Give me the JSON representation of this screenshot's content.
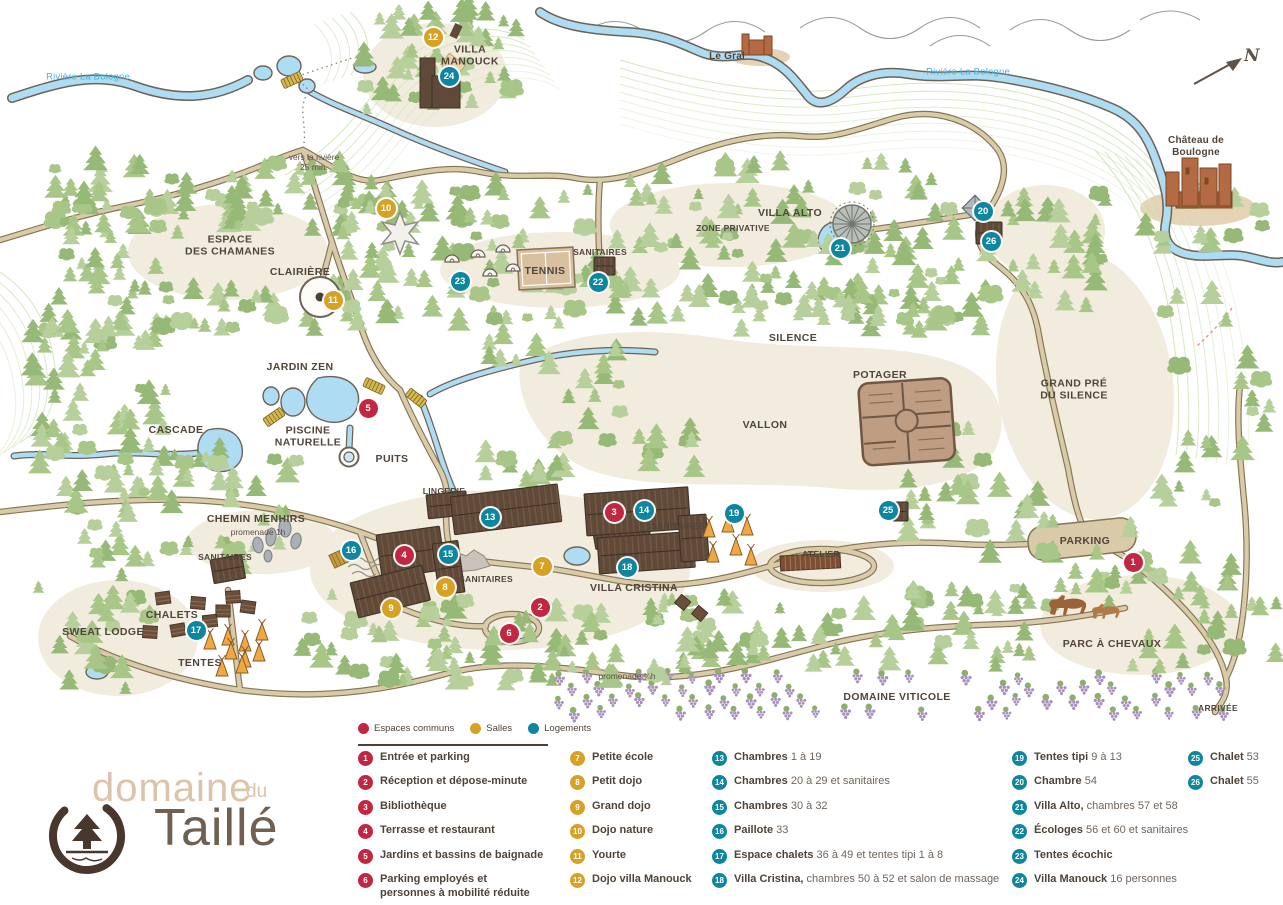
{
  "logo": {
    "word1": "domaine",
    "word2": "du",
    "word3": "Taillé"
  },
  "compass": {
    "label": "N"
  },
  "colors": {
    "red": "#c22742",
    "gold": "#d7a124",
    "teal": "#0e86a0",
    "river": "#aedcf2",
    "river_label": "#49b4d9",
    "path": "#d9cba8",
    "path_edge": "#857456",
    "tree": "#a7c687",
    "beige": "#f1ecdd",
    "building": "#5f4938",
    "text": "#51453a"
  },
  "legend": {
    "key": [
      {
        "label": "Espaces communs",
        "color": "red"
      },
      {
        "label": "Salles",
        "color": "gold"
      },
      {
        "label": "Logements",
        "color": "teal"
      }
    ],
    "columns": [
      {
        "items": [
          {
            "number": "1",
            "color": "red",
            "bold": "Entrée et parking",
            "rest": ""
          },
          {
            "number": "2",
            "color": "red",
            "bold": "Réception et dépose-minute",
            "rest": ""
          },
          {
            "number": "3",
            "color": "red",
            "bold": "Bibliothèque",
            "rest": ""
          },
          {
            "number": "4",
            "color": "red",
            "bold": "Terrasse et restaurant",
            "rest": ""
          },
          {
            "number": "5",
            "color": "red",
            "bold": "Jardins et bassins de baignade",
            "rest": ""
          },
          {
            "number": "6",
            "color": "red",
            "bold": "Parking employés et\npersonnes à mobilité réduite",
            "rest": ""
          }
        ]
      },
      {
        "items": [
          {
            "number": "7",
            "color": "gold",
            "bold": "Petite école",
            "rest": ""
          },
          {
            "number": "8",
            "color": "gold",
            "bold": "Petit dojo",
            "rest": ""
          },
          {
            "number": "9",
            "color": "gold",
            "bold": "Grand dojo",
            "rest": ""
          },
          {
            "number": "10",
            "color": "gold",
            "bold": "Dojo nature",
            "rest": ""
          },
          {
            "number": "11",
            "color": "gold",
            "bold": "Yourte",
            "rest": ""
          },
          {
            "number": "12",
            "color": "gold",
            "bold": "Dojo villa Manouck",
            "rest": ""
          }
        ]
      },
      {
        "items": [
          {
            "number": "13",
            "color": "teal",
            "bold": "Chambres",
            "rest": "1 à 19"
          },
          {
            "number": "14",
            "color": "teal",
            "bold": "Chambres",
            "rest": "20 à 29 et sanitaires"
          },
          {
            "number": "15",
            "color": "teal",
            "bold": "Chambres",
            "rest": "30 à 32"
          },
          {
            "number": "16",
            "color": "teal",
            "bold": "Paillote",
            "rest": "33"
          },
          {
            "number": "17",
            "color": "teal",
            "bold": "Espace chalets",
            "rest": "36 à 49 et tentes tipi 1 à 8"
          },
          {
            "number": "18",
            "color": "teal",
            "bold": "Villa Cristina,",
            "rest": "chambres 50 à 52 et salon de massage"
          }
        ]
      },
      {
        "items": [
          {
            "number": "19",
            "color": "teal",
            "bold": "Tentes tipi",
            "rest": "9 à 13"
          },
          {
            "number": "20",
            "color": "teal",
            "bold": "Chambre",
            "rest": "54"
          },
          {
            "number": "21",
            "color": "teal",
            "bold": "Villa Alto,",
            "rest": "chambres 57 et 58"
          },
          {
            "number": "22",
            "color": "teal",
            "bold": "Écologes",
            "rest": "56 et 60 et sanitaires"
          },
          {
            "number": "23",
            "color": "teal",
            "bold": "Tentes écochic",
            "rest": ""
          },
          {
            "number": "24",
            "color": "teal",
            "bold": "Villa Manouck",
            "rest": "16 personnes"
          }
        ]
      },
      {
        "items": [
          {
            "number": "25",
            "color": "teal",
            "bold": "Chalet",
            "rest": "53"
          },
          {
            "number": "26",
            "color": "teal",
            "bold": "Chalet",
            "rest": "55"
          }
        ]
      }
    ]
  },
  "map": {
    "labels": [
      {
        "text": "Rivière La Bologne",
        "x": 88,
        "y": 77,
        "type": "river"
      },
      {
        "text": "Rivière La Bologne",
        "x": 968,
        "y": 72,
        "type": "river"
      },
      {
        "text": "VILLA\nMANOUCK",
        "x": 470,
        "y": 56,
        "type": "area"
      },
      {
        "text": "vers la rivière\n25 min.",
        "x": 314,
        "y": 162,
        "type": "small"
      },
      {
        "text": "Le Gral",
        "x": 727,
        "y": 57,
        "type": "place"
      },
      {
        "text": "Château de Boulogne",
        "x": 1196,
        "y": 147,
        "type": "place"
      },
      {
        "text": "ESPACE\nDES CHAMANES",
        "x": 230,
        "y": 246,
        "type": "area"
      },
      {
        "text": "ZONE PRIVATIVE",
        "x": 733,
        "y": 228,
        "type": "area-sm"
      },
      {
        "text": "VILLA ALTO",
        "x": 790,
        "y": 213,
        "type": "area"
      },
      {
        "text": "CLAIRIÈRE",
        "x": 300,
        "y": 272,
        "type": "area"
      },
      {
        "text": "TENNIS",
        "x": 545,
        "y": 271,
        "type": "area"
      },
      {
        "text": "SANITAIRES",
        "x": 600,
        "y": 252,
        "type": "area-sm"
      },
      {
        "text": "SILENCE",
        "x": 793,
        "y": 338,
        "type": "area"
      },
      {
        "text": "JARDIN ZEN",
        "x": 300,
        "y": 367,
        "type": "area"
      },
      {
        "text": "POTAGER",
        "x": 880,
        "y": 375,
        "type": "area"
      },
      {
        "text": "GRAND PRÉ\nDU SILENCE",
        "x": 1074,
        "y": 390,
        "type": "area"
      },
      {
        "text": "CASCADE",
        "x": 176,
        "y": 430,
        "type": "area"
      },
      {
        "text": "PISCINE\nNATURELLE",
        "x": 308,
        "y": 437,
        "type": "area"
      },
      {
        "text": "VALLON",
        "x": 765,
        "y": 425,
        "type": "area"
      },
      {
        "text": "PUITS",
        "x": 392,
        "y": 459,
        "type": "area"
      },
      {
        "text": "CHEMIN MENHIRS",
        "x": 256,
        "y": 519,
        "type": "area"
      },
      {
        "text": "promenade 1h",
        "x": 258,
        "y": 532,
        "type": "small"
      },
      {
        "text": "SANITAIRES",
        "x": 225,
        "y": 557,
        "type": "area-sm"
      },
      {
        "text": "LINGERIE",
        "x": 444,
        "y": 491,
        "type": "area-sm"
      },
      {
        "text": "SANITAIRES",
        "x": 486,
        "y": 579,
        "type": "area-sm"
      },
      {
        "text": "SANITAIRES",
        "x": 678,
        "y": 526,
        "type": "area-sm"
      },
      {
        "text": "VILLA CRISTINA",
        "x": 634,
        "y": 588,
        "type": "area"
      },
      {
        "text": "SWEAT LODGE",
        "x": 103,
        "y": 632,
        "type": "area"
      },
      {
        "text": "CHALETS",
        "x": 172,
        "y": 615,
        "type": "area"
      },
      {
        "text": "TENTES",
        "x": 200,
        "y": 663,
        "type": "area"
      },
      {
        "text": "ATELIER",
        "x": 821,
        "y": 554,
        "type": "area-sm"
      },
      {
        "text": "PARKING",
        "x": 1085,
        "y": 541,
        "type": "area"
      },
      {
        "text": "PARC À CHEVAUX",
        "x": 1112,
        "y": 644,
        "type": "area"
      },
      {
        "text": "ARRIVÉE",
        "x": 1218,
        "y": 708,
        "type": "area-sm"
      },
      {
        "text": "DOMAINE VITICOLE",
        "x": 897,
        "y": 697,
        "type": "area"
      },
      {
        "text": "promenade ¼h",
        "x": 627,
        "y": 676,
        "type": "small"
      }
    ],
    "markers": [
      {
        "number": "1",
        "color": "red",
        "x": 1133,
        "y": 562
      },
      {
        "number": "2",
        "color": "red",
        "x": 540,
        "y": 607
      },
      {
        "number": "3",
        "color": "red",
        "x": 614,
        "y": 512
      },
      {
        "number": "4",
        "color": "red",
        "x": 404,
        "y": 555
      },
      {
        "number": "5",
        "color": "red",
        "x": 368,
        "y": 408
      },
      {
        "number": "6",
        "color": "red",
        "x": 509,
        "y": 633
      },
      {
        "number": "7",
        "color": "gold",
        "x": 542,
        "y": 566
      },
      {
        "number": "8",
        "color": "gold",
        "x": 445,
        "y": 587
      },
      {
        "number": "9",
        "color": "gold",
        "x": 391,
        "y": 608
      },
      {
        "number": "10",
        "color": "gold",
        "x": 386,
        "y": 208
      },
      {
        "number": "11",
        "color": "gold",
        "x": 333,
        "y": 300
      },
      {
        "number": "12",
        "color": "gold",
        "x": 433,
        "y": 37
      },
      {
        "number": "13",
        "color": "teal",
        "x": 490,
        "y": 517
      },
      {
        "number": "14",
        "color": "teal",
        "x": 644,
        "y": 510
      },
      {
        "number": "15",
        "color": "teal",
        "x": 448,
        "y": 554
      },
      {
        "number": "16",
        "color": "teal",
        "x": 351,
        "y": 550
      },
      {
        "number": "17",
        "color": "teal",
        "x": 196,
        "y": 630
      },
      {
        "number": "18",
        "color": "teal",
        "x": 627,
        "y": 567
      },
      {
        "number": "19",
        "color": "teal",
        "x": 734,
        "y": 513
      },
      {
        "number": "20",
        "color": "teal",
        "x": 983,
        "y": 211
      },
      {
        "number": "21",
        "color": "teal",
        "x": 840,
        "y": 248
      },
      {
        "number": "22",
        "color": "teal",
        "x": 598,
        "y": 282
      },
      {
        "number": "23",
        "color": "teal",
        "x": 460,
        "y": 281
      },
      {
        "number": "24",
        "color": "teal",
        "x": 449,
        "y": 76
      },
      {
        "number": "25",
        "color": "teal",
        "x": 888,
        "y": 510
      },
      {
        "number": "26",
        "color": "teal",
        "x": 991,
        "y": 241
      }
    ]
  }
}
